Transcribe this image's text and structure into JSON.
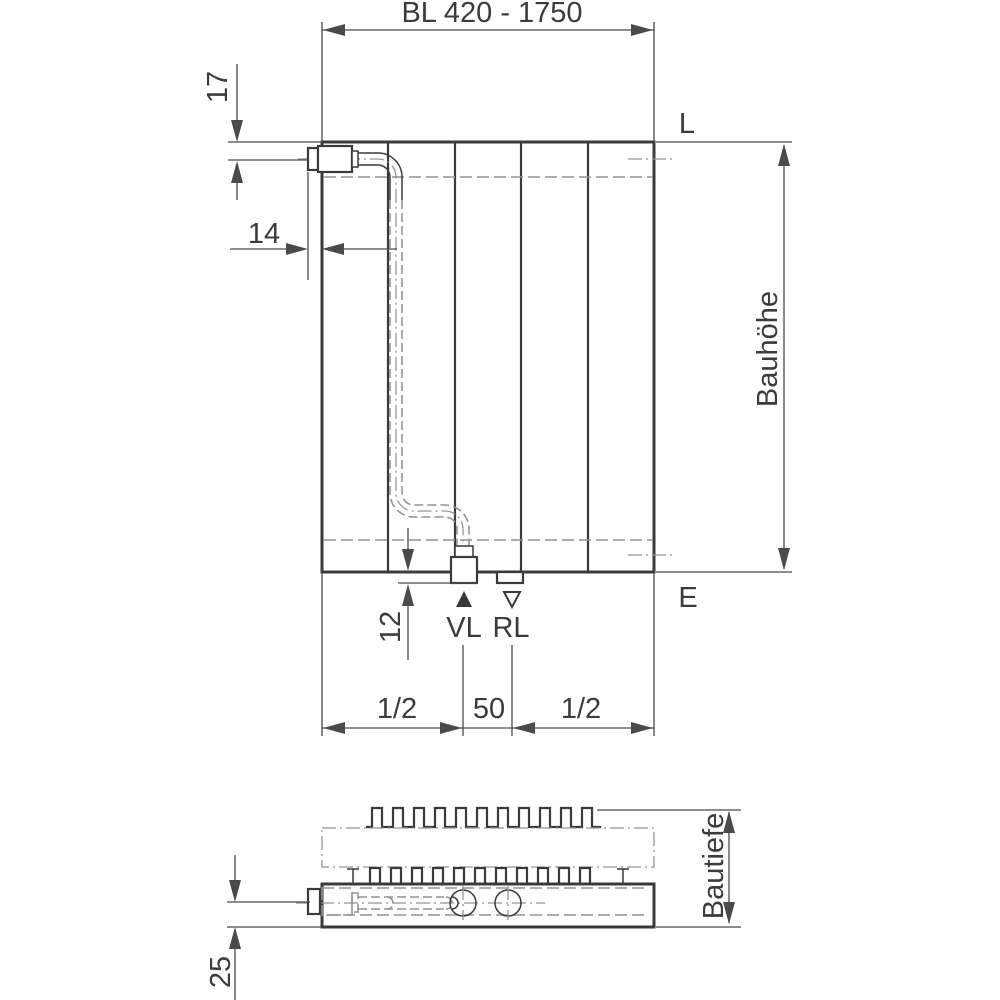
{
  "colors": {
    "line": "#3a3a3a",
    "dim": "#4a4a4a",
    "hidden": "#949494",
    "text": "#3b3b3b",
    "bg": "#ffffff"
  },
  "front_view": {
    "dim_length": "BL 420 - 1750",
    "dim_valve_top_offset": "17",
    "dim_valve_protrusion": "14",
    "label_top_right": "L",
    "label_bottom_right": "E",
    "dim_height": "Bauhöhe",
    "dim_nub_projection": "12",
    "label_supply": "VL",
    "label_return": "RL",
    "dim_half_left": "1/2",
    "dim_center_spacing": "50",
    "dim_half_right": "1/2"
  },
  "plan_view": {
    "dim_depth": "Bautiefe",
    "dim_pipe_offset": "25"
  }
}
